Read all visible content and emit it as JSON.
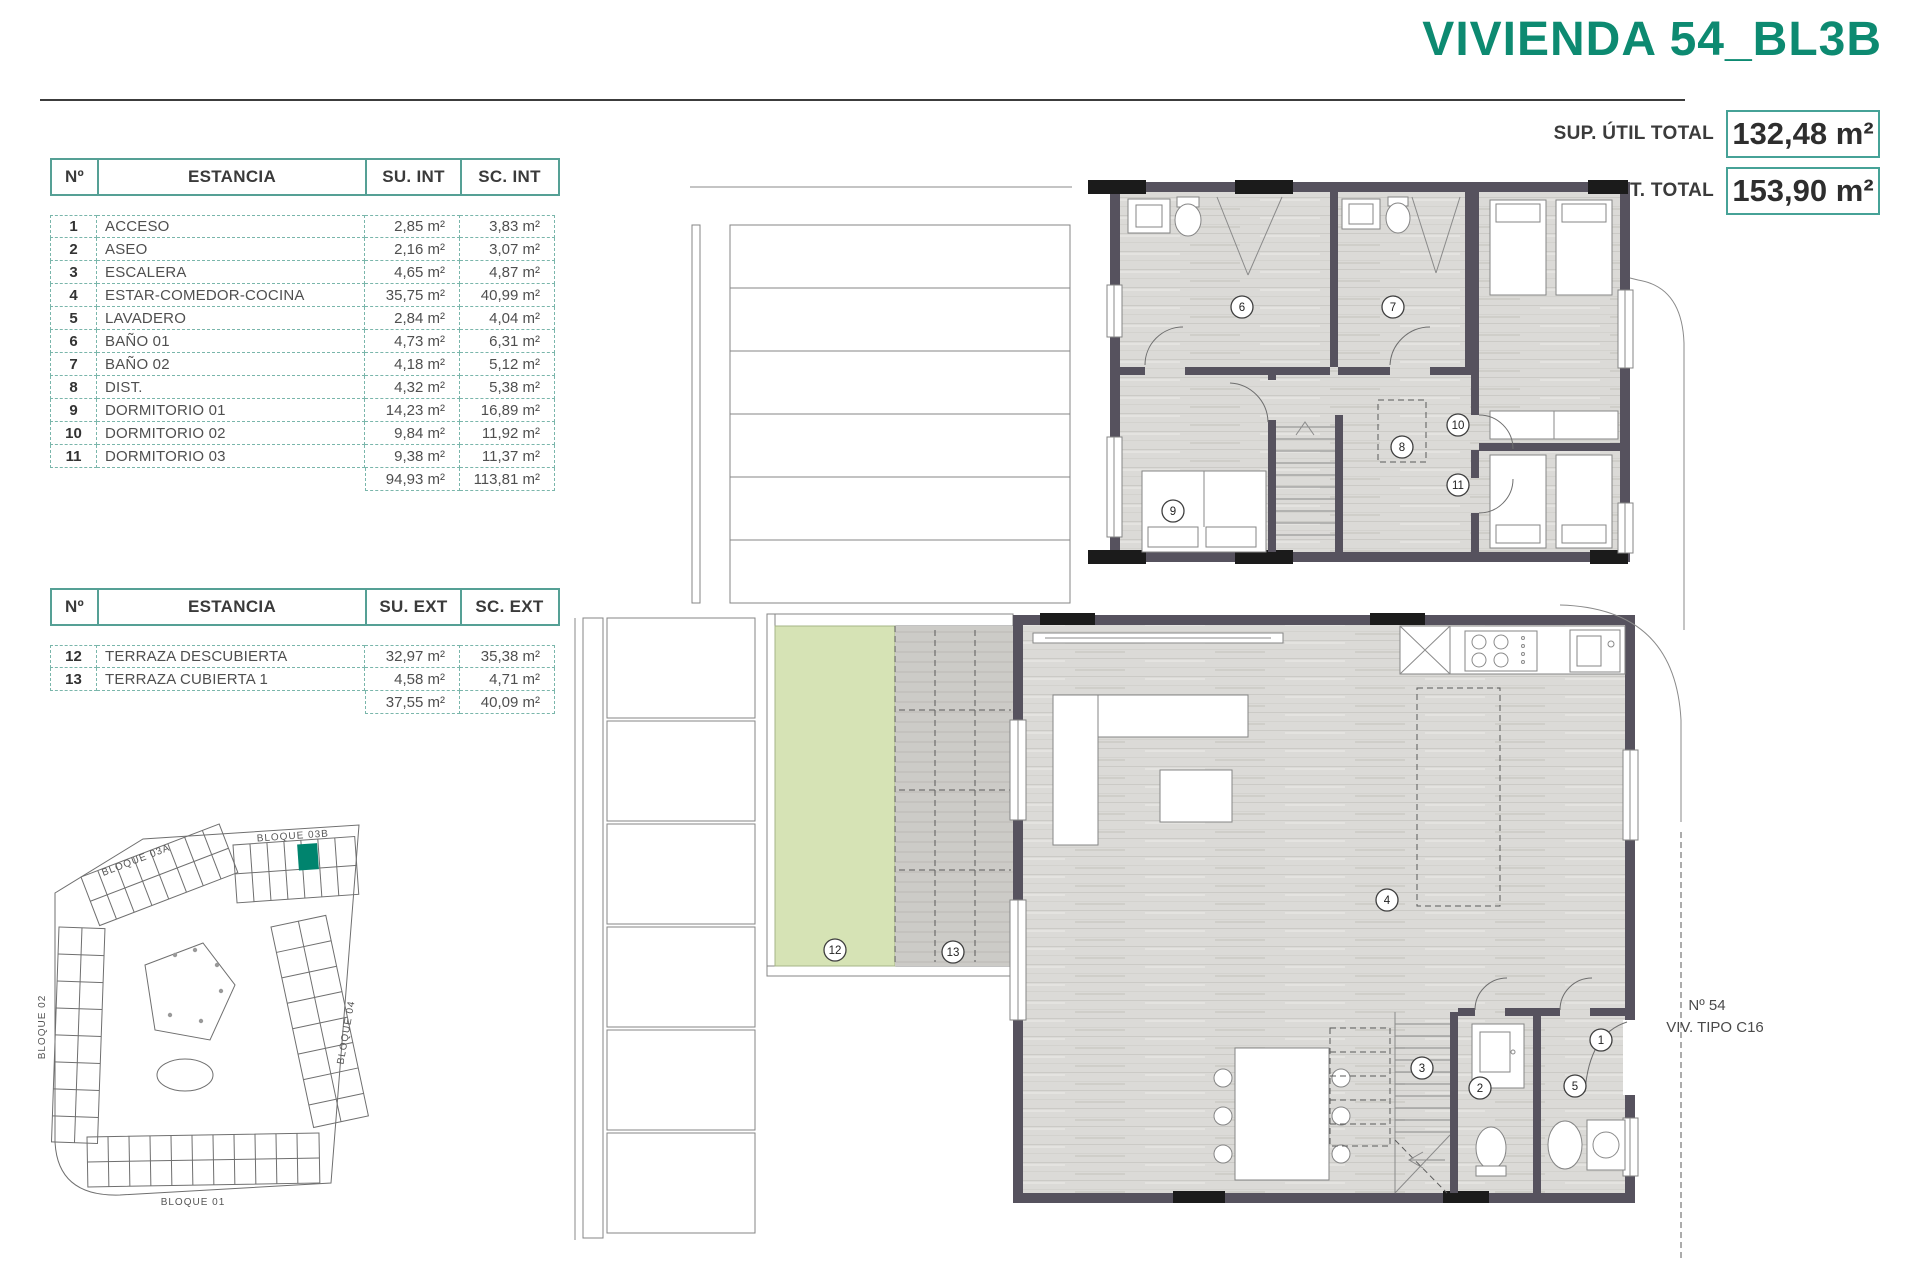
{
  "title": "VIVIENDA 54_BL3B",
  "totals": {
    "util_label": "SUP. ÚTIL TOTAL",
    "util_value": "132,48 m²",
    "const_label": "SUP. CONST. TOTAL",
    "const_value": "153,90 m²"
  },
  "interior_table": {
    "headers": [
      "Nº",
      "ESTANCIA",
      "SU. INT",
      "SC. INT"
    ],
    "rows": [
      [
        "1",
        "ACCESO",
        "2,85 m²",
        "3,83 m²"
      ],
      [
        "2",
        "ASEO",
        "2,16 m²",
        "3,07 m²"
      ],
      [
        "3",
        "ESCALERA",
        "4,65 m²",
        "4,87 m²"
      ],
      [
        "4",
        "ESTAR-COMEDOR-COCINA",
        "35,75 m²",
        "40,99 m²"
      ],
      [
        "5",
        "LAVADERO",
        "2,84 m²",
        "4,04 m²"
      ],
      [
        "6",
        "BAÑO 01",
        "4,73 m²",
        "6,31 m²"
      ],
      [
        "7",
        "BAÑO 02",
        "4,18 m²",
        "5,12 m²"
      ],
      [
        "8",
        "DIST.",
        "4,32 m²",
        "5,38 m²"
      ],
      [
        "9",
        "DORMITORIO 01",
        "14,23 m²",
        "16,89 m²"
      ],
      [
        "10",
        "DORMITORIO 02",
        "9,84 m²",
        "11,92 m²"
      ],
      [
        "11",
        "DORMITORIO 03",
        "9,38 m²",
        "11,37 m²"
      ]
    ],
    "totals": [
      "94,93 m²",
      "113,81 m²"
    ]
  },
  "exterior_table": {
    "headers": [
      "Nº",
      "ESTANCIA",
      "SU. EXT",
      "SC. EXT"
    ],
    "rows": [
      [
        "12",
        "TERRAZA DESCUBIERTA",
        "32,97 m²",
        "35,38 m²"
      ],
      [
        "13",
        "TERRAZA CUBIERTA 1",
        "4,58 m²",
        "4,71 m²"
      ]
    ],
    "totals": [
      "37,55 m²",
      "40,09 m²"
    ]
  },
  "site_plan": {
    "blocks": {
      "b03a": "BLOQUE 03A",
      "b03b": "BLOQUE 03B",
      "b02": "BLOQUE 02",
      "b04": "BLOQUE 04",
      "b01": "BLOQUE 01"
    },
    "highlight_color": "#00846E"
  },
  "floor_plans": {
    "upper": {
      "markers": [
        {
          "n": "6",
          "x": 552,
          "y": 132
        },
        {
          "n": "7",
          "x": 703,
          "y": 132
        },
        {
          "n": "8",
          "x": 712,
          "y": 272
        },
        {
          "n": "9",
          "x": 483,
          "y": 336
        },
        {
          "n": "10",
          "x": 768,
          "y": 250
        },
        {
          "n": "11",
          "x": 768,
          "y": 310
        }
      ]
    },
    "lower": {
      "markers": [
        {
          "n": "12",
          "x": 260,
          "y": 350
        },
        {
          "n": "13",
          "x": 378,
          "y": 352
        },
        {
          "n": "4",
          "x": 812,
          "y": 300
        },
        {
          "n": "1",
          "x": 1026,
          "y": 440
        },
        {
          "n": "2",
          "x": 905,
          "y": 488
        },
        {
          "n": "3",
          "x": 847,
          "y": 468
        },
        {
          "n": "5",
          "x": 1000,
          "y": 486
        }
      ],
      "unit_no": "Nº 54",
      "unit_type": "VIV. TIPO C16"
    }
  },
  "colors": {
    "accent": "#0D8A71",
    "wall": "#56525E",
    "table_border": "#55A095",
    "terrace_green": "#D6E3B5",
    "deck": "#CBCAC6"
  }
}
